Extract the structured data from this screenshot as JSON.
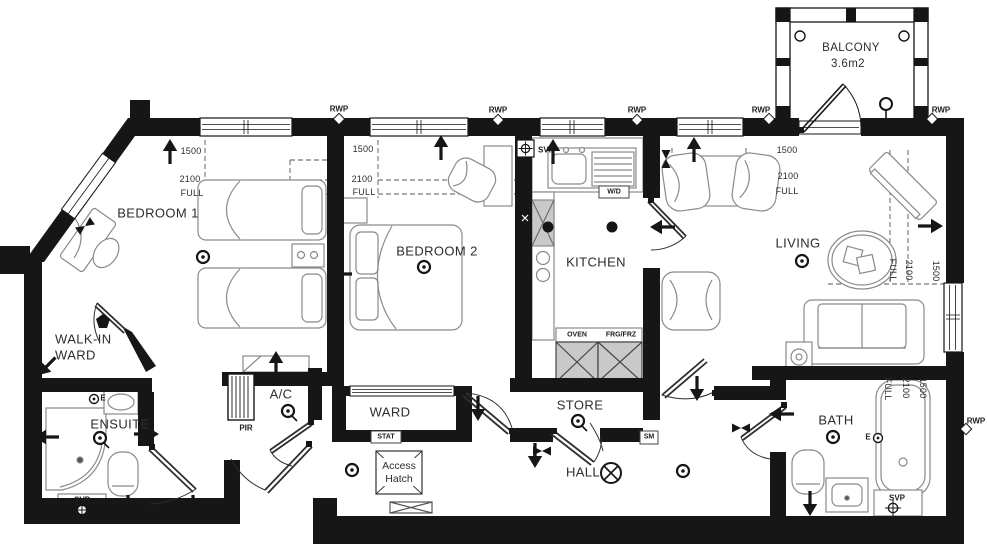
{
  "rooms": {
    "bedroom1": "BEDROOM 1",
    "bedroom2": "BEDROOM 2",
    "kitchen": "KITCHEN",
    "living": "LIVING",
    "walkin_line1": "WALK-IN",
    "walkin_line2": "WARD",
    "ensuite": "ENSUITE",
    "ac": "A/C",
    "ward": "WARD",
    "store": "STORE",
    "hall": "HALL",
    "bath": "BATH",
    "balcony": "BALCONY",
    "balcony_area": "3.6m2"
  },
  "dims": {
    "h1500": "1500",
    "h2100": "2100",
    "full": "FULL"
  },
  "services": {
    "rwp": "RWP",
    "svp": "SVP",
    "pir": "PIR",
    "stat": "STAT",
    "sm": "SM",
    "wd": "W/D",
    "oven": "OVEN",
    "frg": "FRG/FRZ",
    "e": "E"
  },
  "annotations": {
    "access1": "Access",
    "access2": "Hatch"
  },
  "colors": {
    "wall": "#161616",
    "background": "#ffffff",
    "hatch": "#c9c9c9",
    "furniture_line": "#8a8a8a"
  }
}
